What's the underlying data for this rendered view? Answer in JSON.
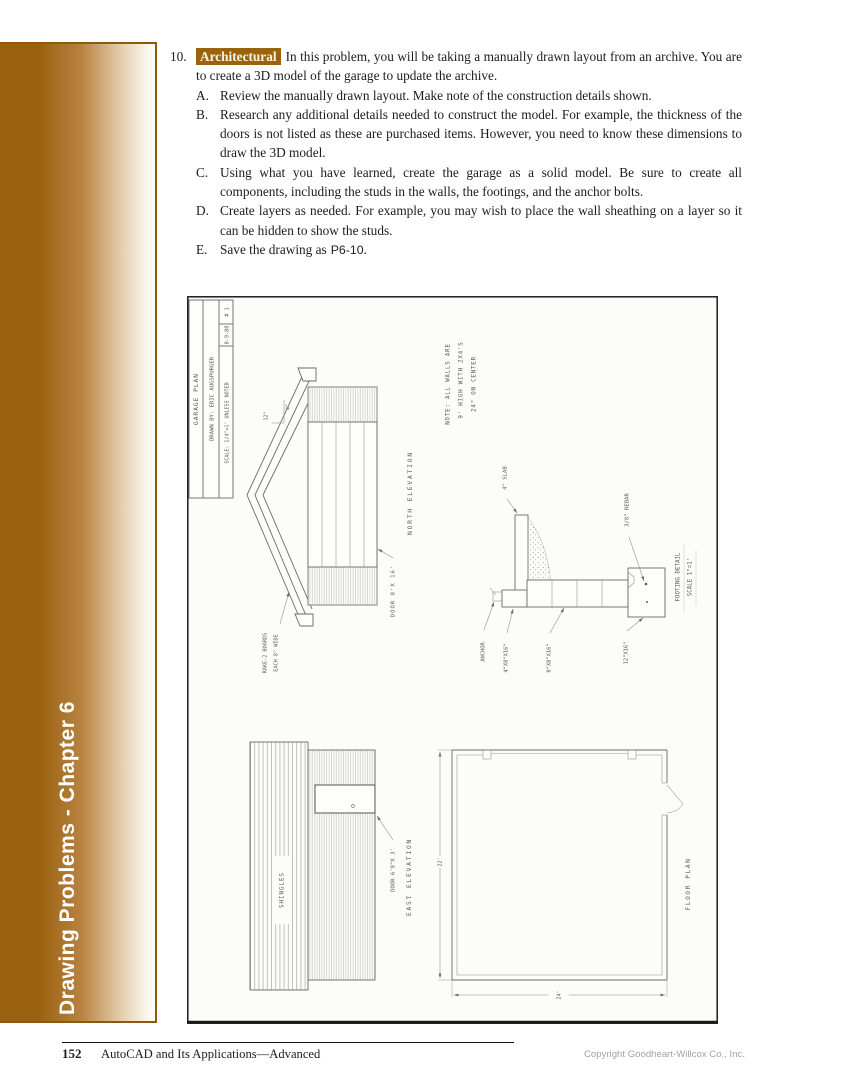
{
  "colors": {
    "accent_brown": "#9a610e"
  },
  "page": {
    "sidebar_label": "Drawing Problems - Chapter 6",
    "footer": {
      "page_number": "152",
      "book_title": "AutoCAD and Its Applications—Advanced",
      "copyright": "Copyright Goodheart-Willcox Co., Inc."
    }
  },
  "problem": {
    "number": "10.",
    "tag": "Architectural",
    "intro": "In this problem, you will be taking a manually drawn layout from an archive. You are to create a 3D model of the garage to update the archive.",
    "steps": [
      {
        "letter": "A.",
        "text": "Review the manually drawn layout. Make note of the construction details shown."
      },
      {
        "letter": "B.",
        "text": "Research any additional details needed to construct the model. For example, the thickness of the doors is not listed as these are purchased items. However, you need to know these dimensions to draw the 3D model."
      },
      {
        "letter": "C.",
        "text": "Using what you have learned, create the garage as a solid model. Be sure to create all components, including the studs in the walls, the footings, and the anchor bolts."
      },
      {
        "letter": "D.",
        "text": "Create layers as needed. For example, you may wish to place the wall sheathing on a layer so it can be hidden to show the studs."
      },
      {
        "letter": "E.",
        "text_before": "Save the drawing as",
        "filename": "P6-10",
        "text_after": "."
      }
    ]
  },
  "figure": {
    "title_block": {
      "row1": "GARAGE PLAN",
      "row2": "DRAWN BY:  ERIC AUGSPURGER",
      "row3": "SCALE: 1/4\"=1' UNLESS NOTED",
      "date": "8-9-88",
      "sheet": "# 1"
    },
    "north_elevation": {
      "label": "NORTH ELEVATION",
      "door_label": "DOOR 8'X 16'",
      "rake_label_1": "RAKE-2 BOARDS",
      "rake_label_2": "EACH 8\" WIDE",
      "pitch_run": "12\"",
      "pitch_rise": "4\""
    },
    "note": {
      "line1": "NOTE:  ALL WALLS ARE",
      "line2": "9' HIGH WITH 2X4'S",
      "line3": "24\" ON CENTER"
    },
    "footing_detail": {
      "slab": "4\" SLAB",
      "anchor": "ANCHOR",
      "block_top": "4\"X8\"X16\"",
      "block_stem": "8\"X8\"X16\"",
      "footing": "12\"X16\"",
      "rebar": "3/8\" REBAR",
      "title1": "FOOTING DETAIL",
      "title2": "SCALE 1\"=1'"
    },
    "east_elevation": {
      "label": "EAST ELEVATION",
      "shingles": "SHINGLES",
      "door_label": "DOOR 6'8\"X 3'"
    },
    "floor_plan": {
      "label": "FLOOR PLAN",
      "dim_left": "22'",
      "dim_bottom": "24'"
    }
  }
}
